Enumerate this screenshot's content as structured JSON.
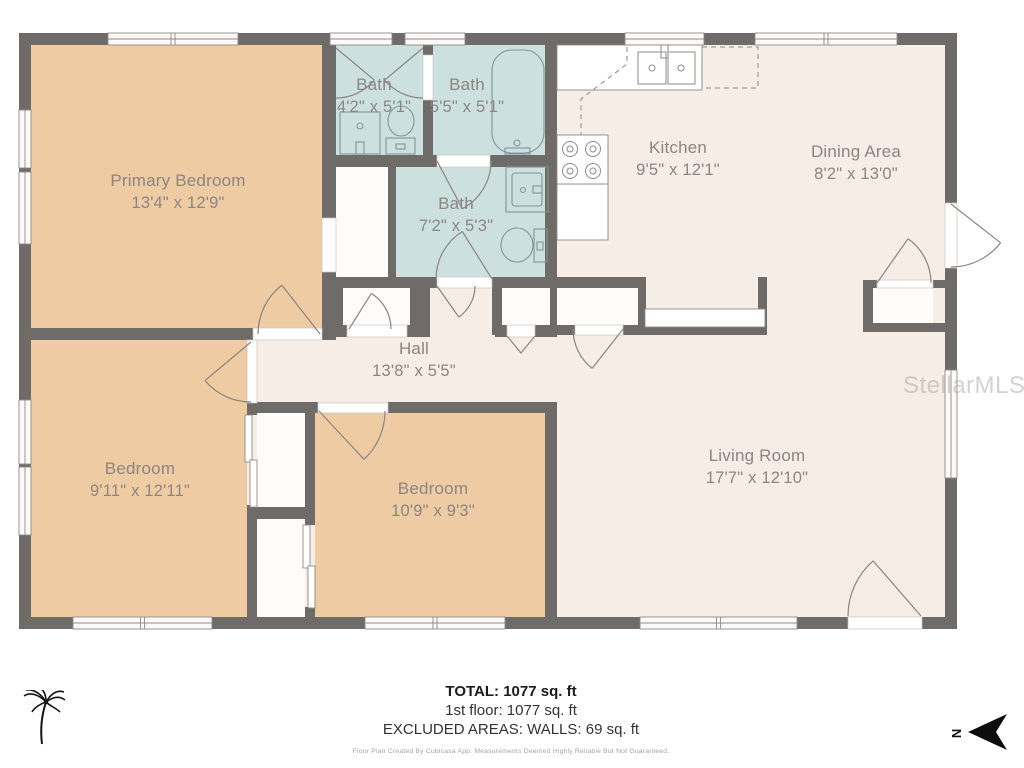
{
  "plan": {
    "rooms": [
      {
        "id": "primary-bedroom",
        "name": "Primary Bedroom",
        "dims": "13'4\" x 12'9\""
      },
      {
        "id": "bath-1",
        "name": "Bath",
        "dims": "4'2\" x 5'1\""
      },
      {
        "id": "bath-2",
        "name": "Bath",
        "dims": "5'5\" x 5'1\""
      },
      {
        "id": "bath-3",
        "name": "Bath",
        "dims": "7'2\" x 5'3\""
      },
      {
        "id": "kitchen",
        "name": "Kitchen",
        "dims": "9'5\" x 12'1\""
      },
      {
        "id": "dining-area",
        "name": "Dining Area",
        "dims": "8'2\" x 13'0\""
      },
      {
        "id": "hall",
        "name": "Hall",
        "dims": "13'8\" x 5'5\""
      },
      {
        "id": "bedroom-left",
        "name": "Bedroom",
        "dims": "9'11\" x 12'11\""
      },
      {
        "id": "bedroom-middle",
        "name": "Bedroom",
        "dims": "10'9\" x 9'3\""
      },
      {
        "id": "living-room",
        "name": "Living Room",
        "dims": "17'7\" x 12'10\""
      }
    ],
    "compass_label": "N"
  },
  "summary": {
    "total": "TOTAL: 1077 sq. ft",
    "first_floor": "1st floor: 1077 sq. ft",
    "excluded": "EXCLUDED AREAS: WALLS: 69 sq. ft",
    "disclaimer": "Floor Plan Created By Cubicasa App. Measurements Deemed Highly Reliable But Not Guaranteed."
  },
  "watermark": "StellarMLS",
  "colors": {
    "wall": "#6f6b69",
    "floor": "#f5ede6",
    "bedroom": "#eecba3",
    "bath": "#cde0e0",
    "closet": "#fdfcfa",
    "fixture": "#7f9598",
    "door": "#8a8580",
    "label": "#8b8681"
  }
}
